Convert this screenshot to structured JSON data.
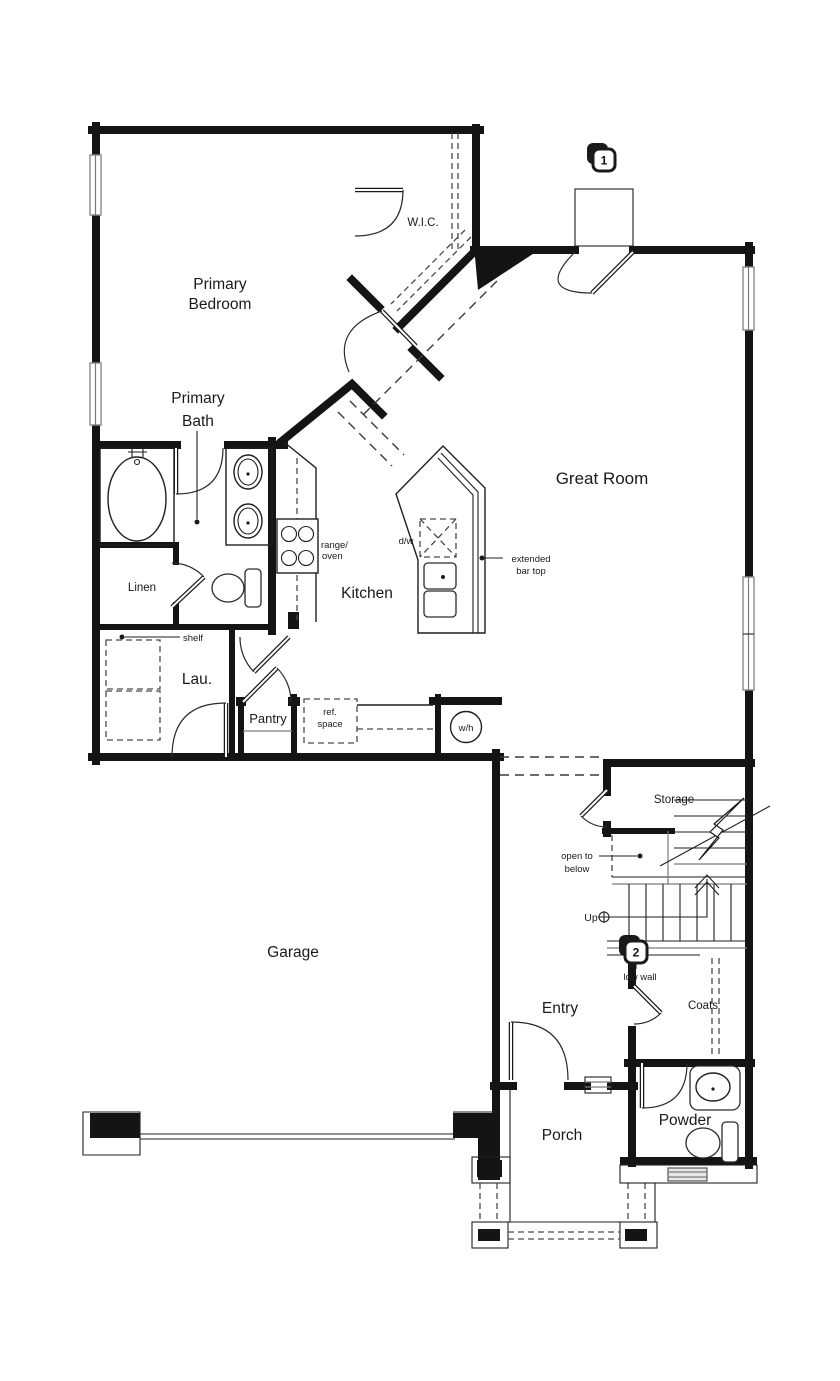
{
  "plan": {
    "rooms": {
      "primary_bedroom": {
        "line1": "Primary",
        "line2": "Bedroom"
      },
      "primary_bath": {
        "line1": "Primary",
        "line2": "Bath"
      },
      "wic": {
        "label": "W.I.C."
      },
      "great_room": {
        "label": "Great Room"
      },
      "kitchen": {
        "label": "Kitchen"
      },
      "linen": {
        "label": "Linen"
      },
      "laundry": {
        "label": "Lau."
      },
      "pantry": {
        "label": "Pantry"
      },
      "garage": {
        "label": "Garage"
      },
      "storage": {
        "label": "Storage"
      },
      "entry": {
        "label": "Entry"
      },
      "porch": {
        "label": "Porch"
      },
      "powder": {
        "label": "Powder"
      },
      "coats": {
        "label": "Coats"
      }
    },
    "annotations": {
      "shelf": "shelf",
      "range_oven": {
        "line1": "range/",
        "line2": "oven"
      },
      "dishwasher": "d/w",
      "extended_bar_top": {
        "line1": "extended",
        "line2": "bar top"
      },
      "ref_space": {
        "line1": "ref.",
        "line2": "space"
      },
      "water_heater": "w/h",
      "open_to_below": {
        "line1": "open to",
        "line2": "below"
      },
      "up": "Up",
      "low_wall": "low wall"
    },
    "markers": {
      "marker1": "1",
      "marker2": "2"
    },
    "colors": {
      "wall": "#141414",
      "thin_line": "#1f1f1f",
      "gray_line": "#7a7a7a",
      "paper": "#ffffff"
    }
  }
}
